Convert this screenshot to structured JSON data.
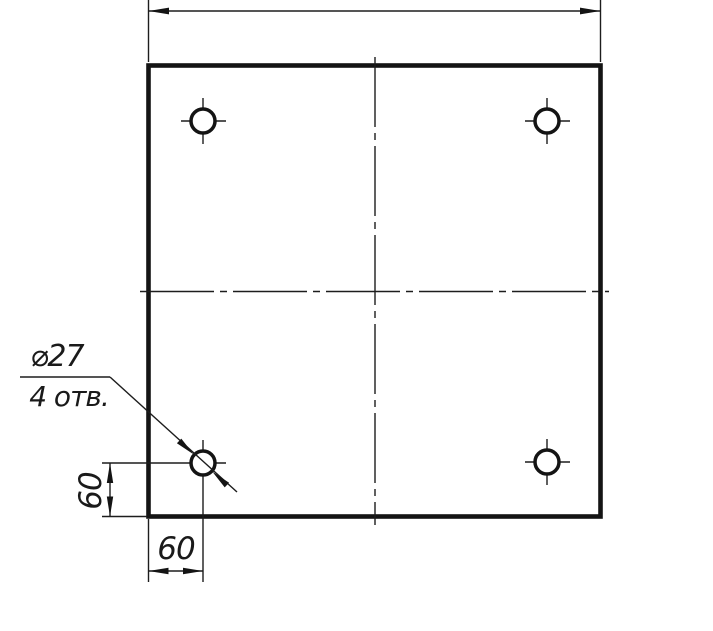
{
  "drawing": {
    "kind": "plate-with-four-holes",
    "annotation_callout": {
      "line1": "⌀27",
      "line2": "4 отв."
    },
    "dimensions": {
      "vertical_offset": "60",
      "horizontal_offset": "60"
    },
    "colors": {
      "ink": "#141414",
      "paper": "#ffffff"
    }
  }
}
